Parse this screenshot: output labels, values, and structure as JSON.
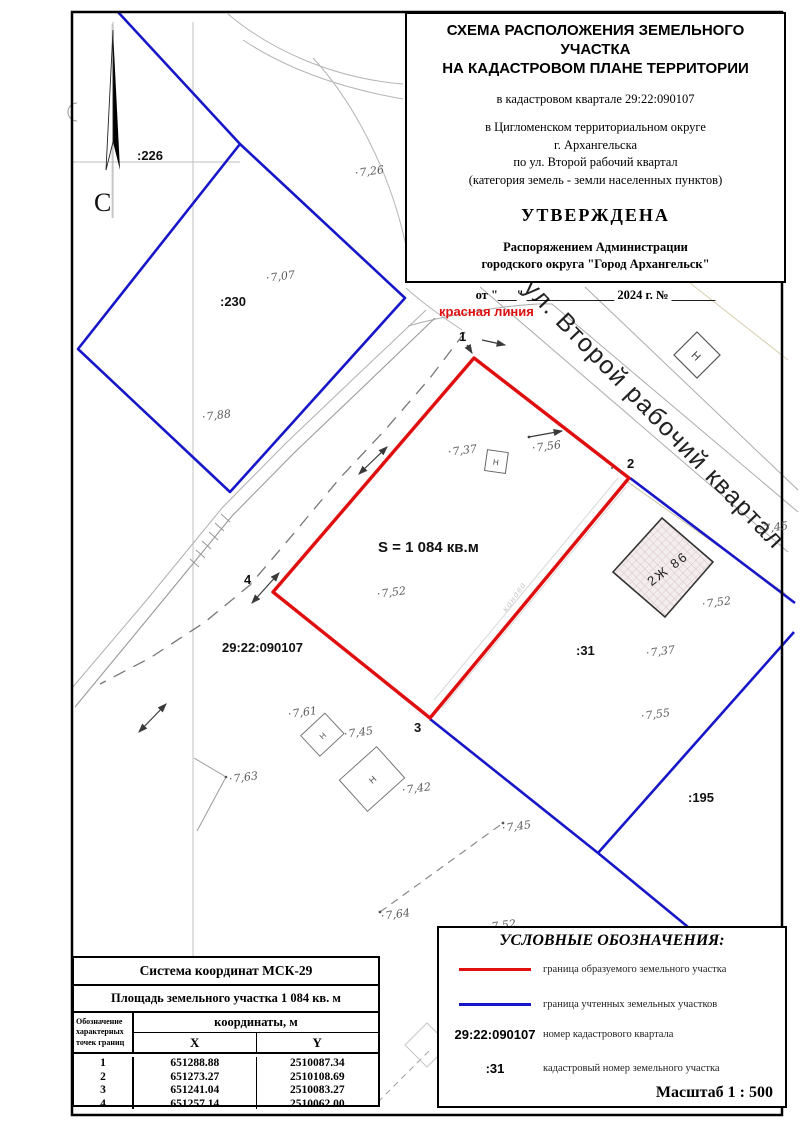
{
  "title_block": {
    "line1": "СХЕМА РАСПОЛОЖЕНИЯ ЗЕМЕЛЬНОГО УЧАСТКА",
    "line2": "НА КАДАСТРОВОМ ПЛАНЕ ТЕРРИТОРИИ",
    "quarter": "в кадастровом квартале 29:22:090107",
    "addr1": "в Цигломенском территориальном округе",
    "addr2": "г. Архангельска",
    "addr3": "по ул. Второй рабочий квартал",
    "addr4": "(категория земель - земли населенных пунктов)",
    "approved": "УТВЕРЖДЕНА",
    "by1": "Распоряжением Администрации",
    "by2": "городского округа \"Город Архангельск\"",
    "date_line": "от  \"___\" ______________ 2024 г. № _______"
  },
  "map": {
    "north": "С",
    "street": "ул. Второй рабочий квартал",
    "red_line": "красная линия",
    "area": "S = 1 084 кв.м",
    "quarter": "29:22:090107",
    "parcel_226": ":226",
    "parcel_230": ":230",
    "parcel_31": ":31",
    "parcel_195": ":195",
    "building": "2Ж 86",
    "nonres": "Н",
    "ditch": "канава",
    "points": {
      "p1": "1",
      "p2": "2",
      "p3": "3",
      "p4": "4"
    },
    "elevations": [
      "7,26",
      "7,07",
      "7,88",
      "7,37",
      "7,56",
      "7,52",
      "7,52",
      "7,37",
      "7,55",
      "7,45",
      "7,61",
      "7,45",
      "7,63",
      "7,42",
      "7,45",
      "7,64",
      "7,52"
    ]
  },
  "table": {
    "coord_system": "Система координат МСК-29",
    "area_row": "Площадь земельного участка 1 084 кв. м",
    "col_points_1": "Обозначение",
    "col_points_2": "характерных",
    "col_points_3": "точек границ",
    "coords_header": "координаты, м",
    "x_header": "X",
    "y_header": "Y",
    "rows": [
      {
        "n": "1",
        "x": "651288.88",
        "y": "2510087.34"
      },
      {
        "n": "2",
        "x": "651273.27",
        "y": "2510108.69"
      },
      {
        "n": "3",
        "x": "651241.04",
        "y": "2510083.27"
      },
      {
        "n": "4",
        "x": "651257.14",
        "y": "2510062.00"
      }
    ]
  },
  "legend": {
    "title": "УСЛОВНЫЕ ОБОЗНАЧЕНИЯ:",
    "items": [
      {
        "sample": "red-line",
        "label": "граница образуемого земельного участка"
      },
      {
        "sample": "blue-line",
        "label": "граница учтенных земельных участков"
      },
      {
        "sample": "29:22:090107",
        "label": "номер кадастрового квартала"
      },
      {
        "sample": ":31",
        "label": "кадастровый номер земельного участка"
      }
    ],
    "scale": "Масштаб  1 : 500"
  },
  "colors": {
    "new_parcel_boundary": "#e00f0f",
    "registered_parcel_boundary": "#1717c9"
  }
}
